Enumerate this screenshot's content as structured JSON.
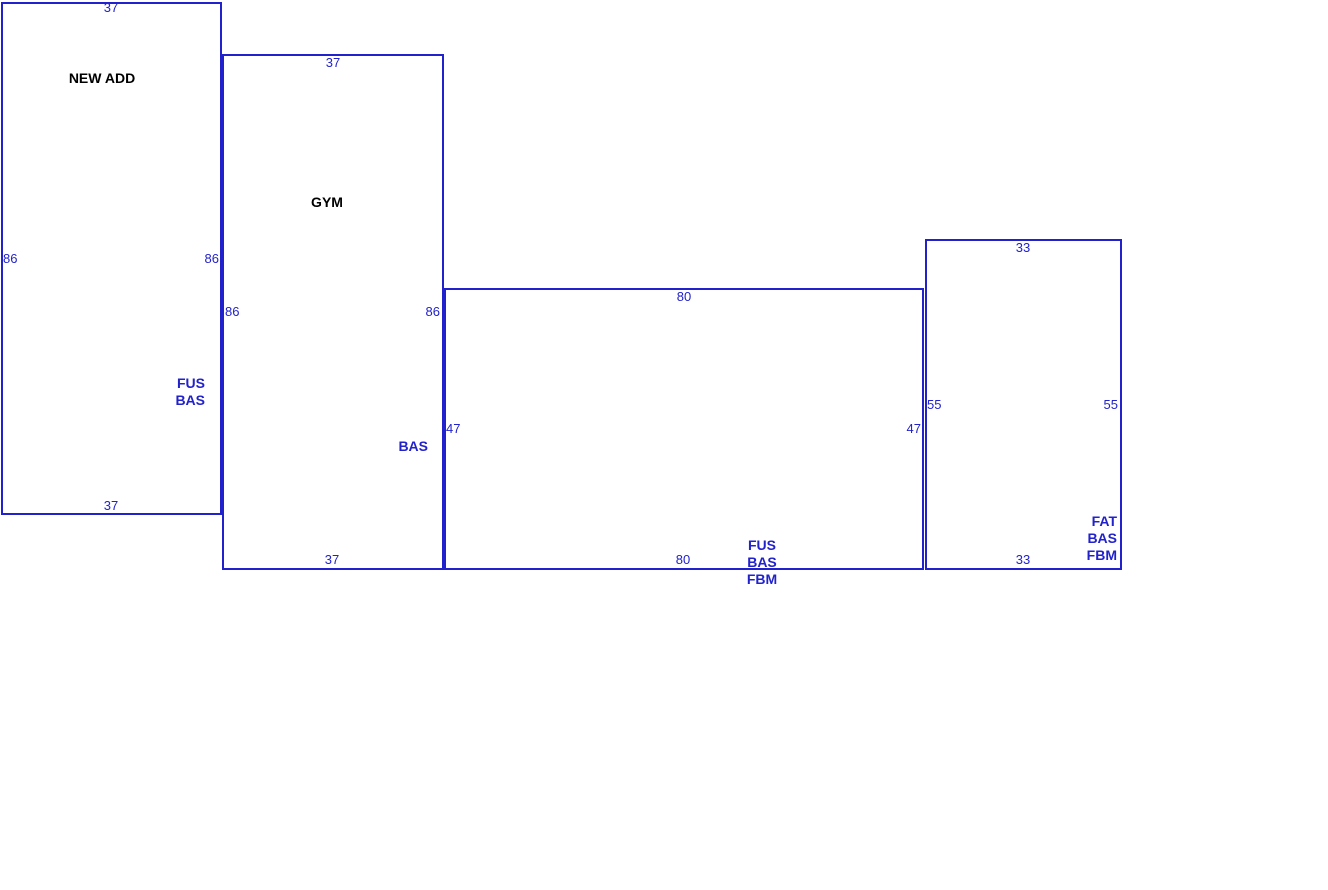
{
  "sketch": {
    "colors": {
      "line": "#2222cc",
      "blue_text": "#2222cc",
      "black_text": "#000000",
      "background": "#ffffff"
    },
    "shapes": [
      {
        "id": "new-add",
        "name": "NEW ADD",
        "dims": {
          "top": "37",
          "bottom": "37",
          "left": "86",
          "right": "86"
        },
        "area_lines": [
          "FUS",
          "BAS"
        ]
      },
      {
        "id": "gym",
        "name": "GYM",
        "dims": {
          "top": "37",
          "bottom": "37",
          "left": "86",
          "right": "86"
        },
        "area_lines": [
          "BAS"
        ]
      },
      {
        "id": "basement-center",
        "dims": {
          "top": "80",
          "bottom": "80",
          "left": "47",
          "right": "47"
        },
        "area_lines": [
          "FUS",
          "BAS",
          "FBM"
        ]
      },
      {
        "id": "basement-right",
        "dims": {
          "top": "33",
          "bottom": "33",
          "left": "55",
          "right": "55"
        },
        "area_lines": [
          "FAT",
          "BAS",
          "FBM"
        ]
      }
    ]
  }
}
